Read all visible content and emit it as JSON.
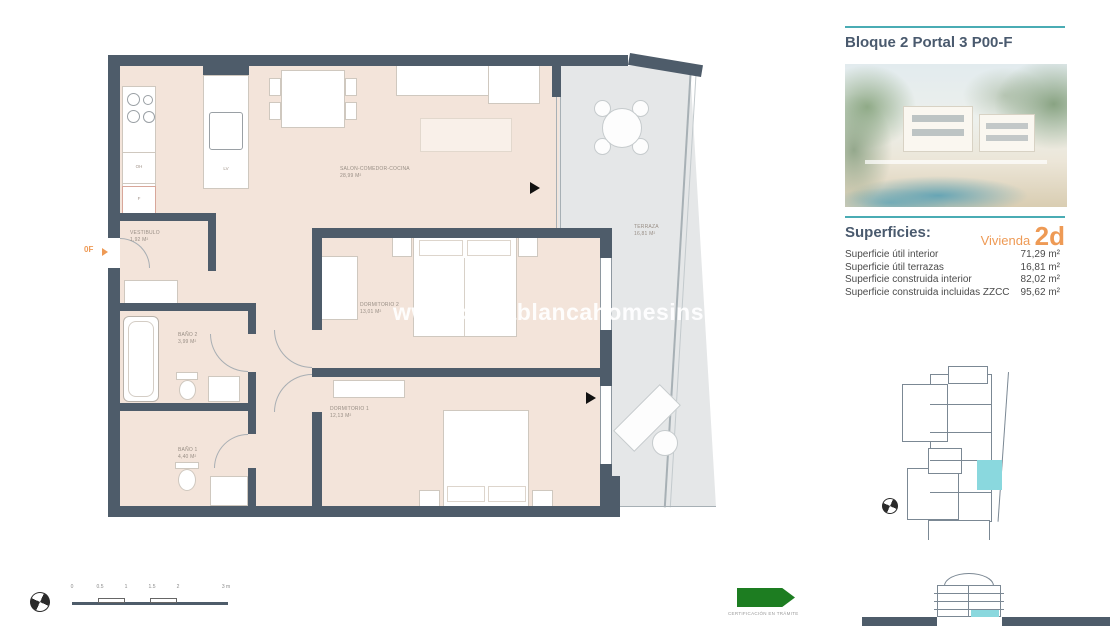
{
  "header": {
    "title": "Bloque 2 Portal 3 P00-F"
  },
  "superficies": {
    "heading": "Superficies:",
    "vivienda_label": "Vivienda",
    "vivienda_code": "2d",
    "rows": [
      {
        "label": "Superficie útil interior",
        "value": "71,29 m²"
      },
      {
        "label": "Superficie útil terrazas",
        "value": "16,81 m²"
      },
      {
        "label": "Superficie construida interior",
        "value": "82,02 m²"
      },
      {
        "label": "Superficie construida incluidas ZZCC",
        "value": "95,62 m²"
      }
    ]
  },
  "floorplan": {
    "rooms": [
      {
        "name": "SALON-COMEDOR-COCINA",
        "area": "28,99 m²"
      },
      {
        "name": "VESTIBULO",
        "area": "1,92 m²"
      },
      {
        "name": "DORMITORIO 2",
        "area": "13,01 m²"
      },
      {
        "name": "DORMITORIO 1",
        "area": "12,13 m²"
      },
      {
        "name": "BAÑO 2",
        "area": "3,99 m²"
      },
      {
        "name": "BAÑO 1",
        "area": "4,40 m²"
      },
      {
        "name": "TERRAZA",
        "area": "16,81 m²"
      }
    ],
    "entrance_label": "0F",
    "kitchen": {
      "oven": "OH",
      "fridge": "F",
      "sink": "LV"
    }
  },
  "watermark": {
    "text": "www.costablancahomesinspain.com"
  },
  "scalebar": {
    "labels": [
      "0",
      "0.5",
      "1",
      "1.5",
      "2",
      "3 m"
    ]
  },
  "certification": {
    "label": "CERTIFICACIÓN EN TRÁMITE"
  },
  "colors": {
    "accent_teal": "#4aacb4",
    "accent_orange": "#ee9a55",
    "wall": "#4e5c6a",
    "interior_floor": "#f3e4da",
    "terrace_floor": "#e5e7e8",
    "unit_highlight": "#8ad8de",
    "certification_green": "#1d7d21"
  }
}
